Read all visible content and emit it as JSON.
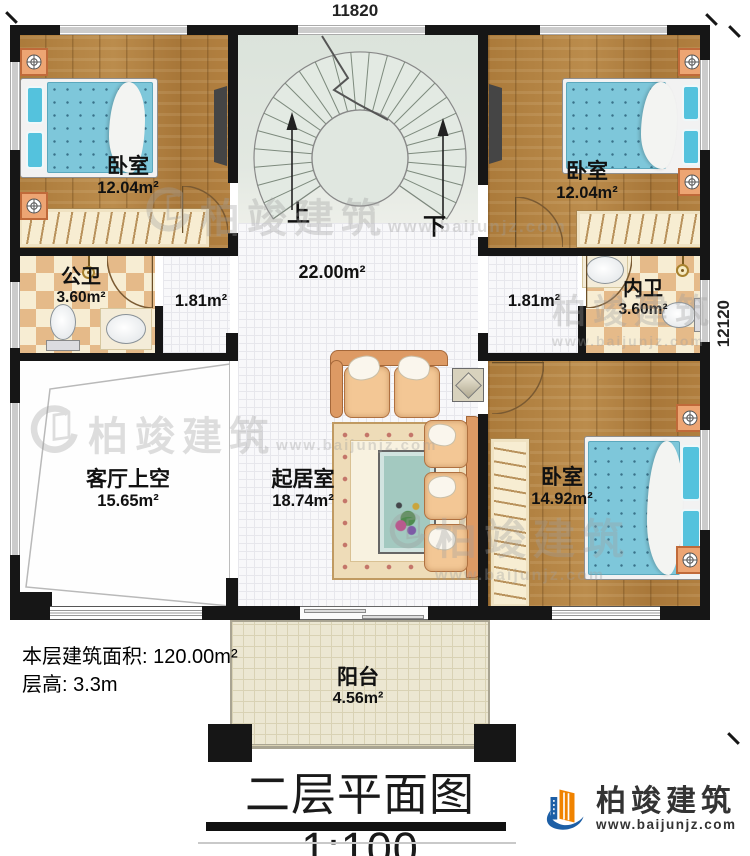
{
  "dimensions": {
    "top": "11820",
    "right": "12120"
  },
  "rooms": {
    "bedroom_tl": {
      "label": "卧室",
      "area": "12.04m²"
    },
    "bedroom_tr": {
      "label": "卧室",
      "area": "12.04m²"
    },
    "public_bath": {
      "label": "公卫",
      "area": "3.60m²"
    },
    "private_bath": {
      "label": "内卫",
      "area": "3.60m²"
    },
    "hall": {
      "area": "22.00m²"
    },
    "corridor_left": {
      "area": "1.81m²"
    },
    "corridor_right": {
      "area": "1.81m²"
    },
    "living_void": {
      "label": "客厅上空",
      "area": "15.65m²"
    },
    "living": {
      "label": "起居室",
      "area": "18.74m²"
    },
    "bedroom_br": {
      "label": "卧室",
      "area": "14.92m²"
    },
    "balcony": {
      "label": "阳台",
      "area": "4.56m²"
    }
  },
  "stairs": {
    "up_label": "上",
    "down_label": "下"
  },
  "info": {
    "floor_area": "本层建筑面积: 120.00m²",
    "floor_height": "层高: 3.3m"
  },
  "title": {
    "text": "二层平面图",
    "scale": "1:100"
  },
  "brand": {
    "name": "柏竣建筑",
    "url": "www.baijunjz.com"
  },
  "watermark": {
    "name": "柏竣建筑",
    "url": "www.baijunjz.com"
  },
  "colors": {
    "wall": "#161616",
    "wood_floor": "#b0803f",
    "brand_blue": "#1d5fa6",
    "brand_orange": "#f08300",
    "mattress_blue": "#7ec7da",
    "checker_tan": "#e5ba89",
    "stair_green": "#dde4dc",
    "balcony_beige": "#ece7d2"
  }
}
